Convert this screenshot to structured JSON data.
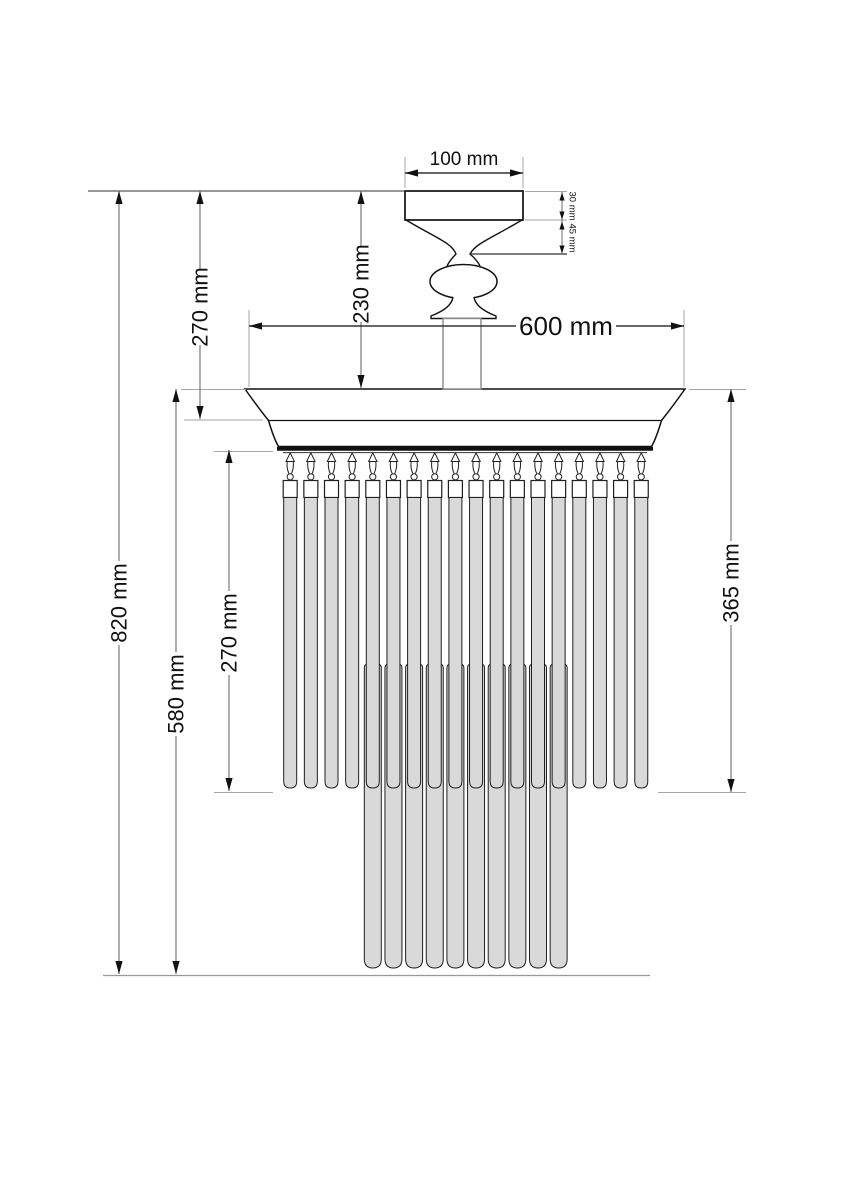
{
  "diagram": {
    "type": "technical dimension drawing",
    "subject": "semi-flush ceiling chandelier with hanging glass rods",
    "units": "mm",
    "dimensions": {
      "canopy_width": "100 mm",
      "canopy_height": "30 mm",
      "neck_height": "45 mm",
      "ceiling_to_crown_top": "230 mm",
      "ceiling_to_crown_band": "270 mm",
      "crown_diameter": "600 mm",
      "total_height": "820 mm",
      "crown_to_long_rod_bottom": "580 mm",
      "rim_to_short_rod_bottom": "270 mm",
      "crown_top_to_short_rod_bottom": "365 mm"
    },
    "fixture": {
      "front_rod_count": 18,
      "back_rod_count": 10,
      "rod_fill": "#d9d9d9",
      "outline_color": "#111111",
      "dimension_line_color": "#777777",
      "extension_line_color": "#a6a6a6",
      "background": "#ffffff"
    }
  }
}
